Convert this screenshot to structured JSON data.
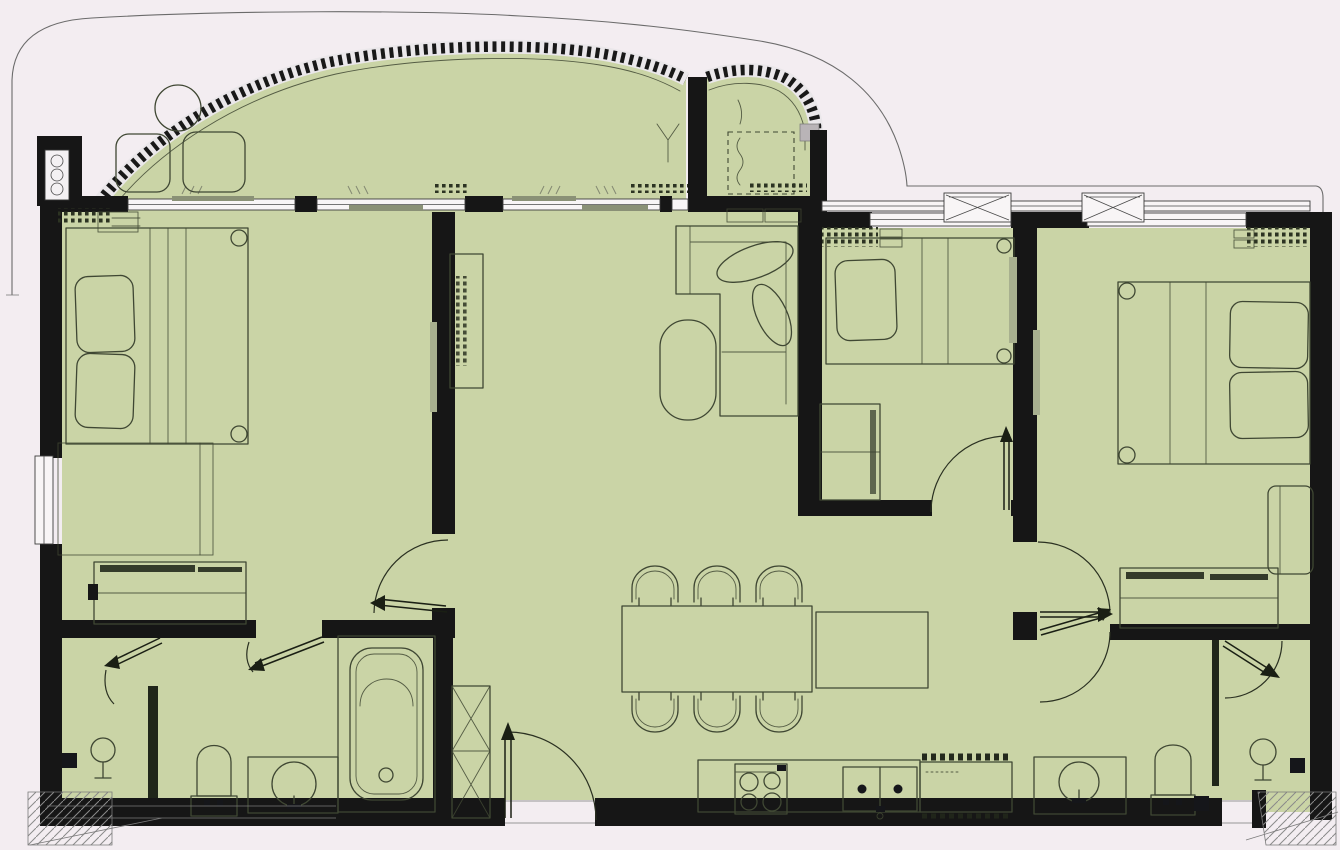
{
  "colors": {
    "background": "#f3edf1",
    "floor": "#cad4a6",
    "wall": "#161616",
    "line": "#3f4733",
    "window_fill": "#f8f5f6",
    "panel": "#8a9176",
    "gray_bar": "#a8b08f",
    "boundary": "#6b6b6b",
    "hatch": "#2e3424"
  },
  "plan": {
    "type": "apartment-floor-plan",
    "text_labels": [],
    "rooms": [
      {
        "id": "balcony",
        "furniture": [
          "round-table",
          "lounge-chair",
          "lounge-chair",
          "planter",
          "plant"
        ]
      },
      {
        "id": "master-bedroom",
        "furniture": [
          "double-bed",
          "pillow",
          "pillow",
          "rug",
          "wardrobe",
          "bedside-shelf"
        ]
      },
      {
        "id": "living-dining",
        "furniture": [
          "tv-console",
          "l-shaped-sofa",
          "coffee-table",
          "dining-table",
          "dining-chairs-x6",
          "sideboard",
          "shoe-cabinet"
        ]
      },
      {
        "id": "kitchen",
        "furniture": [
          "counter",
          "cooktop-4-burner",
          "double-sink",
          "refrigerator"
        ]
      },
      {
        "id": "bathroom-1",
        "furniture": [
          "bathtub",
          "toilet",
          "washbasin",
          "shower-head",
          "floor-drain"
        ]
      },
      {
        "id": "bedroom-2",
        "furniture": [
          "single-bed",
          "pillow",
          "wardrobe"
        ]
      },
      {
        "id": "bedroom-3",
        "furniture": [
          "double-bed",
          "pillow",
          "pillow",
          "wardrobe",
          "desk"
        ]
      },
      {
        "id": "bathroom-2",
        "furniture": [
          "washbasin",
          "toilet",
          "shower-head",
          "floor-drain",
          "glass-partition"
        ]
      },
      {
        "id": "entrance",
        "furniture": [
          "entry-door",
          "threshold"
        ]
      }
    ],
    "exterior": [
      "site-boundary-line",
      "balcony-railing",
      "ac-unit",
      "ac-condenser-boxes",
      "service-ledge-left",
      "service-ledge-right"
    ],
    "doors": [
      "entry-door",
      "master-bedroom-door",
      "bathroom-1-door",
      "shower-room-door",
      "bedroom-2-door",
      "bedroom-3-door",
      "bathroom-2-door",
      "shower-2-door"
    ],
    "windows": [
      "master-window-a",
      "master-window-b",
      "living-sliding-door",
      "left-wall-window",
      "bedroom-2-window",
      "bedroom-3-window"
    ]
  }
}
